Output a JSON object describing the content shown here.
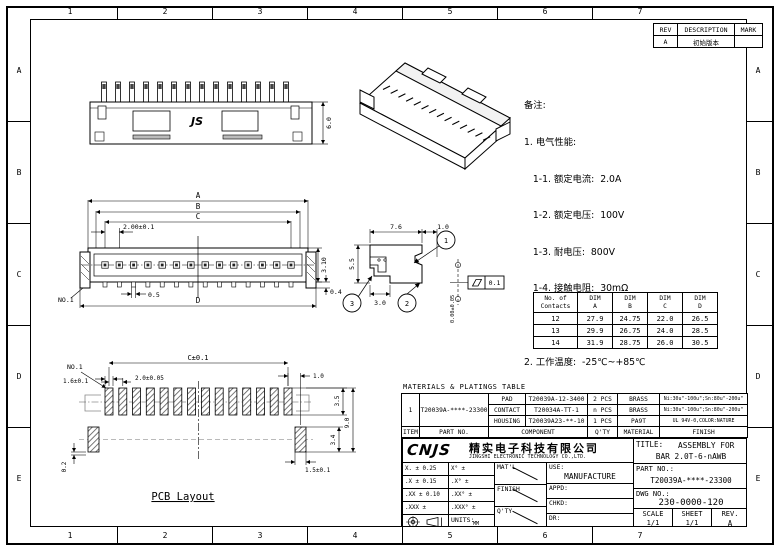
{
  "frame": {
    "cols": [
      "1",
      "2",
      "3",
      "4",
      "5",
      "6",
      "7"
    ],
    "rows": [
      "A",
      "B",
      "C",
      "D",
      "E"
    ]
  },
  "revision_table": {
    "rev_h": "REV",
    "desc_h": "DESCRIPTION",
    "mark_h": "MARK",
    "rows": [
      {
        "rev": "A",
        "desc": "初始版本",
        "mark": ""
      }
    ]
  },
  "notes": {
    "lines": [
      "备注:",
      "1. 电气性能:",
      "   1-1. 额定电流:  2.0A",
      "   1-2. 额定电压:  100V",
      "   1-3. 耐电压:  800V",
      "   1-4. 接触电阻:  30mΩ",
      "   1-5. 绝缘电阻:  1000MΩ",
      "2. 工作温度:  -25℃~+85℃",
      "3. 环境管控:",
      "   3-1. 禁止使用含有SS-00259所限制的物质。",
      "   3-2. 对应第三方测试机构出具的ICP-AES数据和",
      "        不可测定物质的成分表，在一年有效期内。"
    ]
  },
  "top_view": {
    "marking": "JS",
    "dim_height": "6.0"
  },
  "front_view": {
    "dim_a": "A",
    "dim_b": "B",
    "dim_c": "C",
    "dim_d": "D",
    "dim_pitch": "2.00±0.1",
    "dim_h": "3.10",
    "dim_pad": "0.5",
    "dim_standoff": "0.4",
    "pin1": "NO.1"
  },
  "side_view": {
    "dim_w": "7.6",
    "dim_tab": "1.0",
    "dim_h": "5.5",
    "dim_d": "3.0",
    "balloon_1": "1",
    "balloon_2": "2",
    "balloon_3": "3",
    "flatness": "0.1",
    "coplanarity": "0.00±0.05"
  },
  "pcb": {
    "caption": "PCB Layout",
    "dim_c": "C±0.1",
    "dim_pitch": "2.0±0.05",
    "dim_pad_w": "1.6±0.1",
    "dim_offset": "1.0",
    "dim_35": "3.5",
    "dim_90": "9.0",
    "dim_34": "3.4",
    "dim_tab": "1.5±0.1",
    "dim_02": "0.2",
    "pin1": "NO.1"
  },
  "dim_table": {
    "h_contacts_1": "No. of",
    "h_contacts_2": "Contacts",
    "h_dim": "DIM",
    "h_a": "A",
    "h_b": "B",
    "h_c": "C",
    "h_d": "D",
    "rows": [
      {
        "n": "12",
        "a": "27.9",
        "b": "24.75",
        "c": "22.0",
        "d": "26.5"
      },
      {
        "n": "13",
        "a": "29.9",
        "b": "26.75",
        "c": "24.0",
        "d": "28.5"
      },
      {
        "n": "14",
        "a": "31.9",
        "b": "28.75",
        "c": "26.0",
        "d": "30.5"
      }
    ]
  },
  "materials_table": {
    "title": "MATERIALS & PLATINGS TABLE",
    "item": "1",
    "part_no": "T20039A-****-23300",
    "rows": [
      {
        "component": "PAD",
        "part": "T20039A-12-3400",
        "qty": "2 PCS",
        "material": "BRASS",
        "finish": "Ni:30u\"-100u\";Sn:80u\"-200u\""
      },
      {
        "component": "CONTACT",
        "part": "T20034A-TT-1",
        "qty": "n PCS",
        "material": "BRASS",
        "finish": "Ni:30u\"-100u\";Sn:80u\"-200u\""
      },
      {
        "component": "HOUSING",
        "part": "T20039A23-**-10",
        "qty": "1 PCS",
        "material": "PA9T",
        "finish": "UL 94V-0,COLOR:NATURE"
      }
    ],
    "h_item": "ITEM",
    "h_part": "PART NO.",
    "h_component": "COMPONENT",
    "h_qty": "Q'TY",
    "h_material": "MATERIAL",
    "h_finish": "FINISH"
  },
  "title_block": {
    "logo": "CNJS",
    "company_cn": "精实电子科技有限公司",
    "company_en": "JINGSHI ELECTRONIC TECHNOLOGY CO.,LTD.",
    "tol": [
      {
        "lin": "X.  ± 0.25",
        "ang": "X°  ±"
      },
      {
        "lin": ".X  ± 0.15",
        "ang": ".X°  ±"
      },
      {
        "lin": ".XX ± 0.10",
        "ang": ".XX° ±"
      },
      {
        "lin": ".XXX  ±",
        "ang": ".XXX° ±"
      }
    ],
    "units_label": "UNITS:",
    "units_value": "MM",
    "matl": "MAT'L",
    "finish": "FINISH",
    "qty": "Q'TY",
    "use_label": "USE:",
    "use_value": "MANUFACTURE",
    "appd": "APPD:",
    "chkd": "CHKD:",
    "dr": "DR:",
    "title_label": "TITLE:",
    "title_1": "ASSEMBLY FOR",
    "title_2": "BAR 2.0T-6-nAWB",
    "partno_label": "PART NO.:",
    "partno_value": "T20039A-****-23300",
    "dwg_label": "DWG NO.:",
    "dwg_value": "230-0000-120",
    "scale_label": "SCALE",
    "scale_value": "1/1",
    "sheet_label": "SHEET",
    "sheet_value": "1/1",
    "rev_label": "REV.",
    "rev_value": "A"
  }
}
